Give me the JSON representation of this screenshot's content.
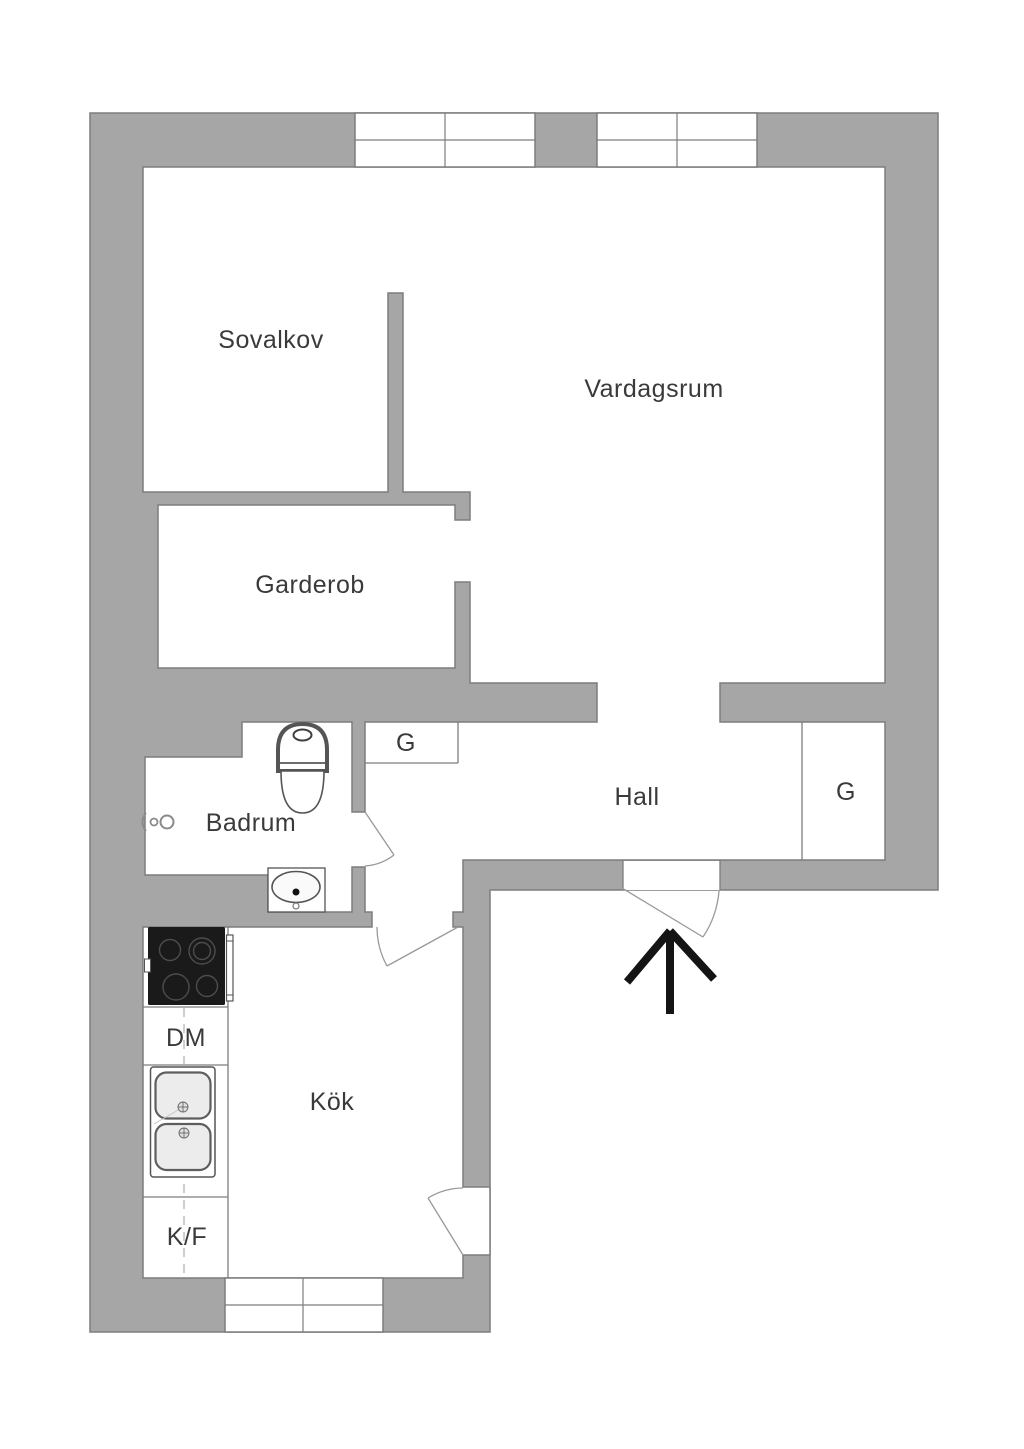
{
  "title": "Apartment floor plan",
  "colors": {
    "wall": "#a6a6a6",
    "outline": "#7d7d7d",
    "text": "#3a3a3a",
    "arrow": "#141414",
    "stove": "#1a1a1a",
    "door_arc": "#999999"
  },
  "rooms": {
    "sovalkov": {
      "label": "Sovalkov"
    },
    "vardagsrum": {
      "label": "Vardagsrum"
    },
    "garderob": {
      "label": "Garderob"
    },
    "badrum": {
      "label": "Badrum"
    },
    "hall": {
      "label": "Hall"
    },
    "kok": {
      "label": "Kök"
    }
  },
  "closets": {
    "hall_left": {
      "label": "G"
    },
    "hall_right": {
      "label": "G"
    }
  },
  "kitchen": {
    "dishwasher": {
      "label": "DM"
    },
    "fridge_freezer": {
      "label": "K/F"
    }
  },
  "icons": {
    "entrance_arrow": "entrance-arrow",
    "toilet": "toilet",
    "bathroom_sink": "bathroom-sink",
    "shower_mixer": "shower-mixer",
    "stove": "stove",
    "kitchen_sink": "kitchen-sink",
    "windows": "window-double-pane"
  }
}
